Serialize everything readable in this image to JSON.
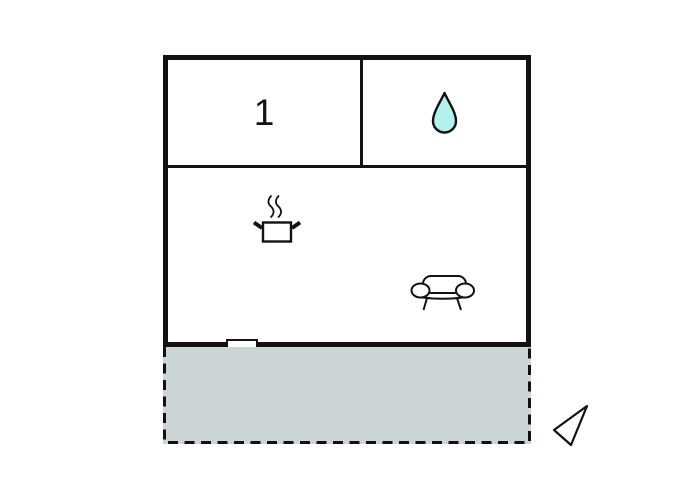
{
  "scene": {
    "background_color": "#ffffff",
    "wall_color": "#121212"
  },
  "floorplan": {
    "room1": {
      "label": "1"
    },
    "bathroom": {
      "icon": "water-drop",
      "drop_fill_color": "#b4f0ec"
    },
    "living_area": {
      "icons": [
        "cooking-pot",
        "sofa"
      ]
    },
    "window": {
      "icon": "window-opening"
    },
    "terrace": {
      "fill_color": "#ccd5d5",
      "border_style": "dashed"
    },
    "compass": {
      "icon": "direction-arrow"
    }
  }
}
